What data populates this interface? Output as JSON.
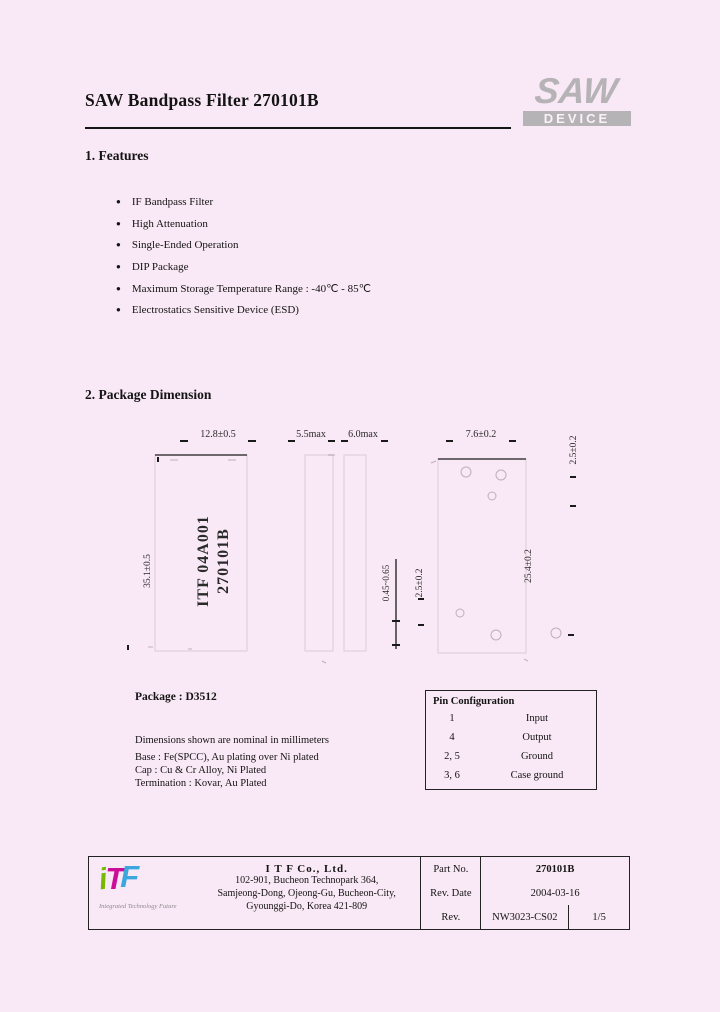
{
  "title": "SAW Bandpass Filter 270101B",
  "brand": {
    "saw": "SAW",
    "device": "DEVICE"
  },
  "features": {
    "heading": "1. Features",
    "items": [
      "IF Bandpass Filter",
      "High Attenuation",
      "Single-Ended Operation",
      "DIP Package",
      "Maximum Storage Temperature Range : -40℃ - 85℃",
      "Electrostatics Sensitive Device (ESD)"
    ]
  },
  "package_dimension": {
    "heading": "2. Package Dimension",
    "front_view": {
      "width_dim": "12.8±0.5",
      "height_dim": "35.1±0.5",
      "marking_line1": "ITF 04A001",
      "marking_line2": "270101B"
    },
    "side_view": {
      "depth_dim1": "5.5max",
      "depth_dim2": "6.0max"
    },
    "bottom_view": {
      "width_dim": "7.6±0.2",
      "pitch_dim_top": "2.5±0.2",
      "length_dim": "25.4±0.2",
      "pitch_dim_bottom": "2.5±0.2",
      "lead_dim": "0.45~0.65"
    },
    "package_label": "Package : D3512",
    "notes": [
      "Dimensions shown are nominal in millimeters",
      "Base : Fe(SPCC), Au plating over Ni plated",
      "Cap : Cu & Cr Alloy, Ni Plated",
      "Termination : Kovar, Au Plated"
    ]
  },
  "pin_configuration": {
    "heading": "Pin Configuration",
    "rows": [
      {
        "pin": "1",
        "function": "Input"
      },
      {
        "pin": "4",
        "function": "Output"
      },
      {
        "pin": "2, 5",
        "function": "Ground"
      },
      {
        "pin": "3, 6",
        "function": "Case ground"
      }
    ]
  },
  "footer": {
    "logo": {
      "i": "i",
      "t": "T",
      "f": "F",
      "tagline": "Integrated Technology Future"
    },
    "company": "I T F   Co., Ltd.",
    "address": [
      "102-901, Bucheon Technopark 364,",
      "Samjeong-Dong, Ojeong-Gu, Bucheon-City,",
      "Gyounggi-Do, Korea 421-809"
    ],
    "doc_table": {
      "part_no_label": "Part No.",
      "part_no_value": "270101B",
      "rev_date_label": "Rev. Date",
      "rev_date_value": "2004-03-16",
      "rev_label": "Rev.",
      "rev_value": "NW3023-CS02",
      "page_value": "1/5"
    }
  },
  "colors": {
    "background": "#f9e8f5",
    "brand_gray": "#b6b3b6",
    "logo_green": "#76b900",
    "logo_magenta": "#cc0d97",
    "logo_blue": "#3ba7dc"
  }
}
